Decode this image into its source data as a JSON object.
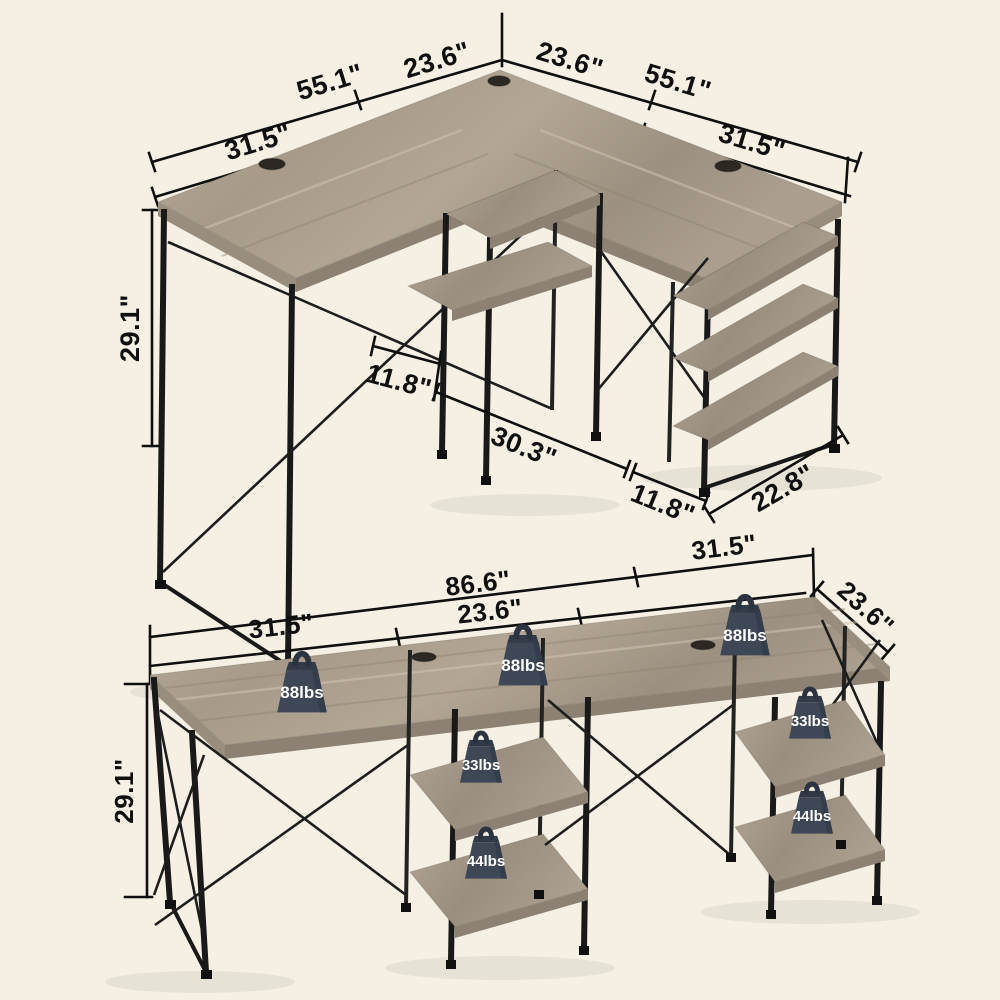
{
  "background": "#f5f0e3",
  "colors": {
    "wood": "#ac9f8f",
    "wood_light": "#bcafa0",
    "wood_dark": "#93877a",
    "frame_black": "#191919",
    "dimension_line": "#0f0f0f",
    "weight_body": "#3e4755",
    "weight_dark": "#313a47",
    "weight_text": "#ffffff"
  },
  "top_diagram": {
    "label": "L-shaped desk dimension view",
    "dims": {
      "left_wing_total": "55.1\"",
      "left_corner_span": "23.6\"",
      "right_corner_span": "23.6\"",
      "right_wing_total": "55.1\"",
      "left_wing_outer": "31.5\"",
      "right_wing_outer": "31.5\"",
      "height": "29.1\"",
      "center_shelf_depth": "11.8\"",
      "knee_clearance": "30.3\"",
      "tower_shelf_depth": "11.8\"",
      "tower_width": "22.8\""
    }
  },
  "bottom_diagram": {
    "label": "Straight desk weight capacity view",
    "dims": {
      "main_span": "86.6\"",
      "right_section": "31.5\"",
      "left_section": "31.5\"",
      "center_section": "23.6\"",
      "depth": "23.6\"",
      "height": "29.1\""
    },
    "weights": {
      "desktop_left": "88lbs",
      "desktop_center": "88lbs",
      "desktop_right": "88lbs",
      "center_tower_upper": "33lbs",
      "center_tower_lower": "44lbs",
      "right_tower_upper": "33lbs",
      "right_tower_lower": "44lbs"
    }
  }
}
